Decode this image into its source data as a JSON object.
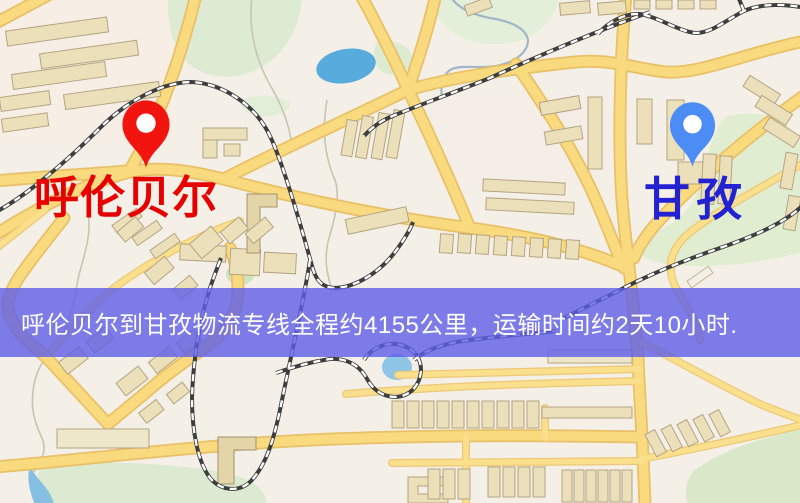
{
  "page": {
    "width": 800,
    "height": 503,
    "kind": "logistics-route-map-image"
  },
  "origin": {
    "name": "呼伦贝尔",
    "pin_color": "#f2150f",
    "label_color": "#e60000"
  },
  "destination": {
    "name": "甘孜",
    "pin_color": "#4c8df5",
    "label_color": "#2222d2"
  },
  "banner": {
    "text": "呼伦贝尔到甘孜物流专线全程约4155公里，运输时间约2天10小时.",
    "background": "rgba(94,94,232,0.8)",
    "text_color": "#ffffff",
    "distance_km": 4155,
    "transit_time": "2天10小时"
  },
  "map_palette": {
    "background": "#f5f0e7",
    "road_fill": "#f9da7e",
    "road_casing": "#e8c068",
    "building": "#ece0bb",
    "park": "#dcebd2",
    "water": "#8fc6e6",
    "lake": "#58abdd",
    "railway": "#3e3e3e"
  }
}
